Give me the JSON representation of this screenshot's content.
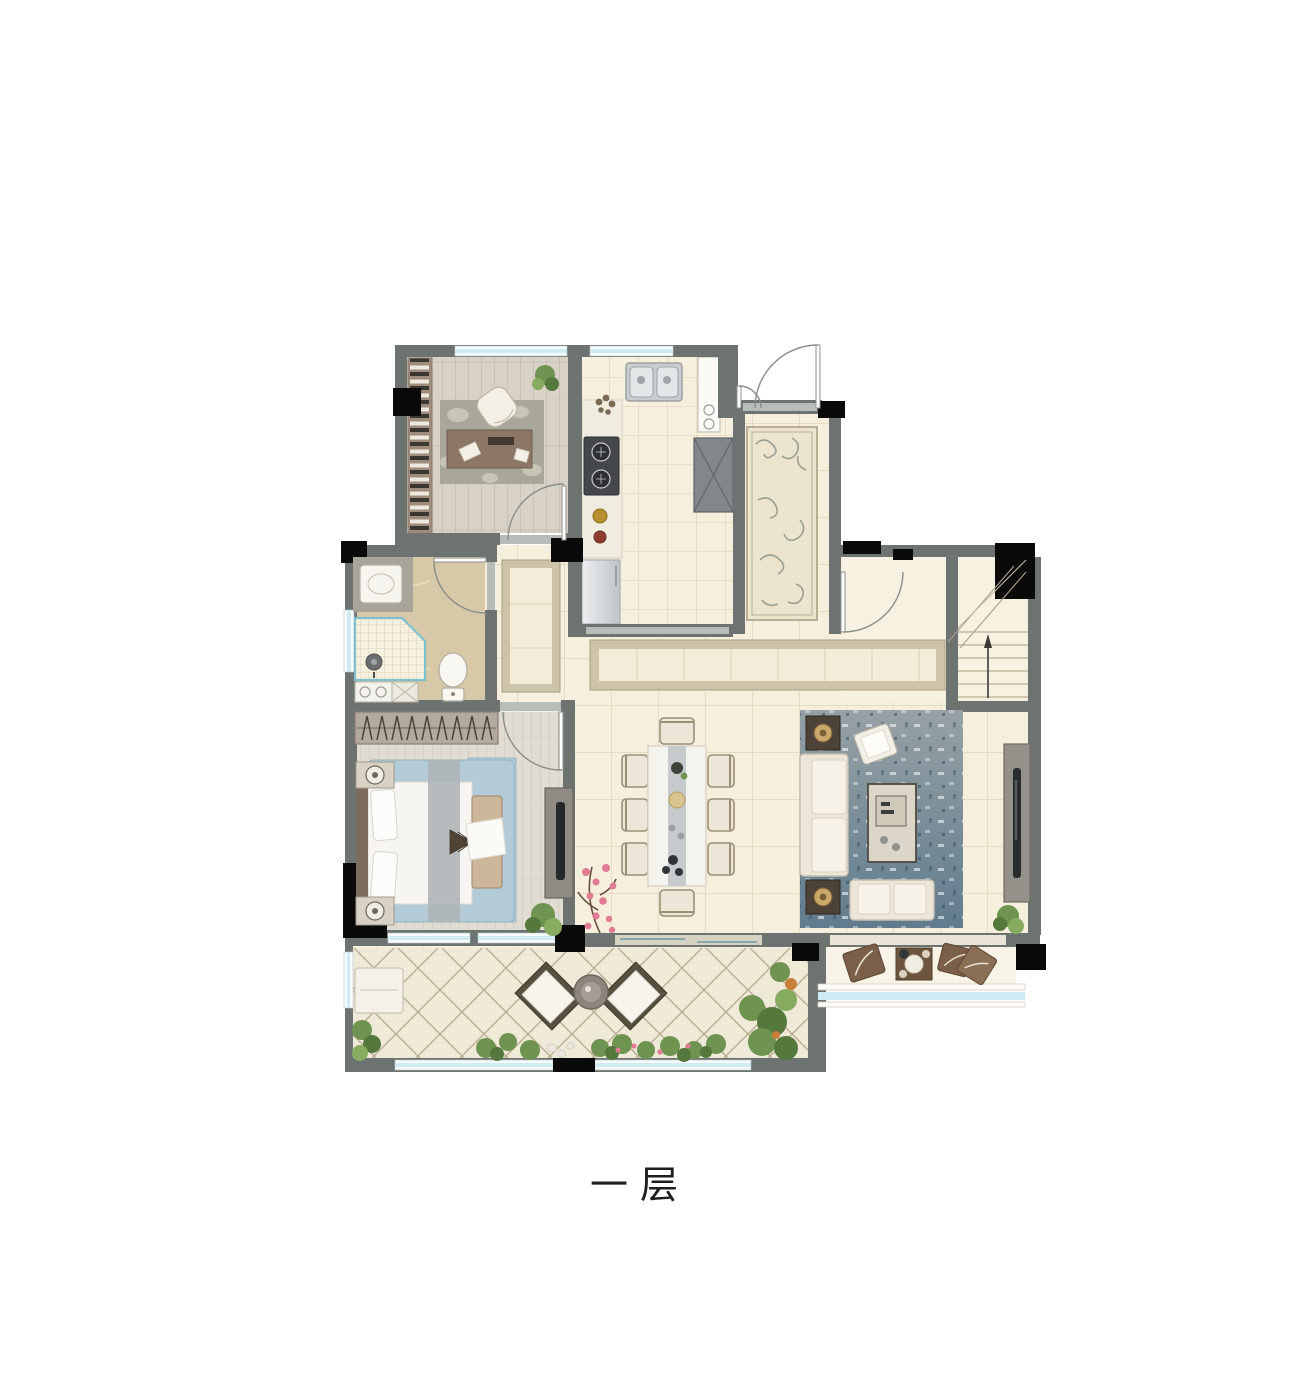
{
  "floor_plan": {
    "label": "一层"
  },
  "palette": {
    "wall": "#6d7370",
    "column": "#0a0a0a",
    "floor_tile": "#f6efdd",
    "tile_line": "#dbcfb3",
    "wood": "#d8d2c6",
    "wood_line": "#bab2a3",
    "plank": "#e1dcd1",
    "plank_line": "#c9c2b4",
    "bath_floor": "#d7c9a7",
    "window_blue": "#cfeaf2",
    "door_arc": "#8a8e89",
    "rug_study": "#a8a79a",
    "rug_entry": "#ece4cd",
    "rug_entry_scroll": "#98a096",
    "rug_living_top": "#96a1a5",
    "rug_living_bottom": "#617c8e",
    "rug_bed": "#b2cbd7",
    "fish": "#3f73a2",
    "terrace_line": "#b7ab90",
    "furn_cream": "#ece6d8",
    "furn_stroke": "#c2bbaa",
    "dark_wood": "#4c4238",
    "steel": "#c9cdd0",
    "plant_green": "#6f9350",
    "plant_dark": "#55793d",
    "blossom": "#e17a94"
  }
}
